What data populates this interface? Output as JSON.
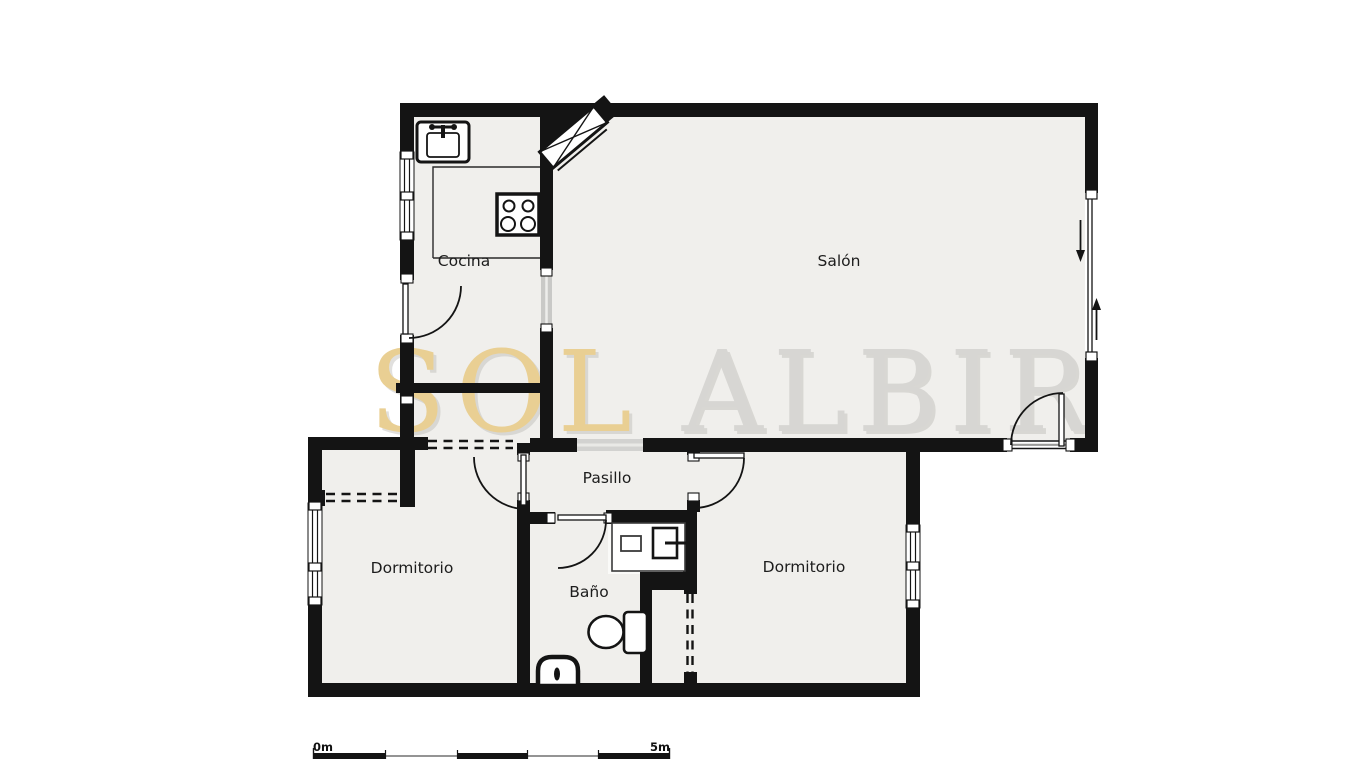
{
  "page": {
    "type": "apartment-floor-plan"
  },
  "watermark": {
    "text_gold": "SOL",
    "text_gray": "ALBIR",
    "gold_color": "#e9cf93",
    "gray_color": "#d7d6d3"
  },
  "rooms": [
    {
      "id": "cocina",
      "label": "Cocina"
    },
    {
      "id": "salon",
      "label": "Salón"
    },
    {
      "id": "pasillo",
      "label": "Pasillo"
    },
    {
      "id": "dormitorio_left",
      "label": "Dormitorio"
    },
    {
      "id": "bano",
      "label": "Baño"
    },
    {
      "id": "dormitorio_right",
      "label": "Dormitorio"
    }
  ],
  "scale_bar": {
    "start_label": "0m",
    "end_label": "5m"
  },
  "fixtures": {
    "kitchen": [
      "sink-icon",
      "stove-icon",
      "counter-outline"
    ],
    "bathroom": [
      "washbasin-icon",
      "toilet-icon",
      "bidet-icon"
    ],
    "entrance": [
      "entrance-door-icon"
    ],
    "salon": [
      "sliding-door-arrows",
      "terrace-door"
    ]
  },
  "colors": {
    "wall": "#141414",
    "floor": "#f0efec",
    "background": "#ffffff",
    "threshold": "#d2d2d0"
  }
}
